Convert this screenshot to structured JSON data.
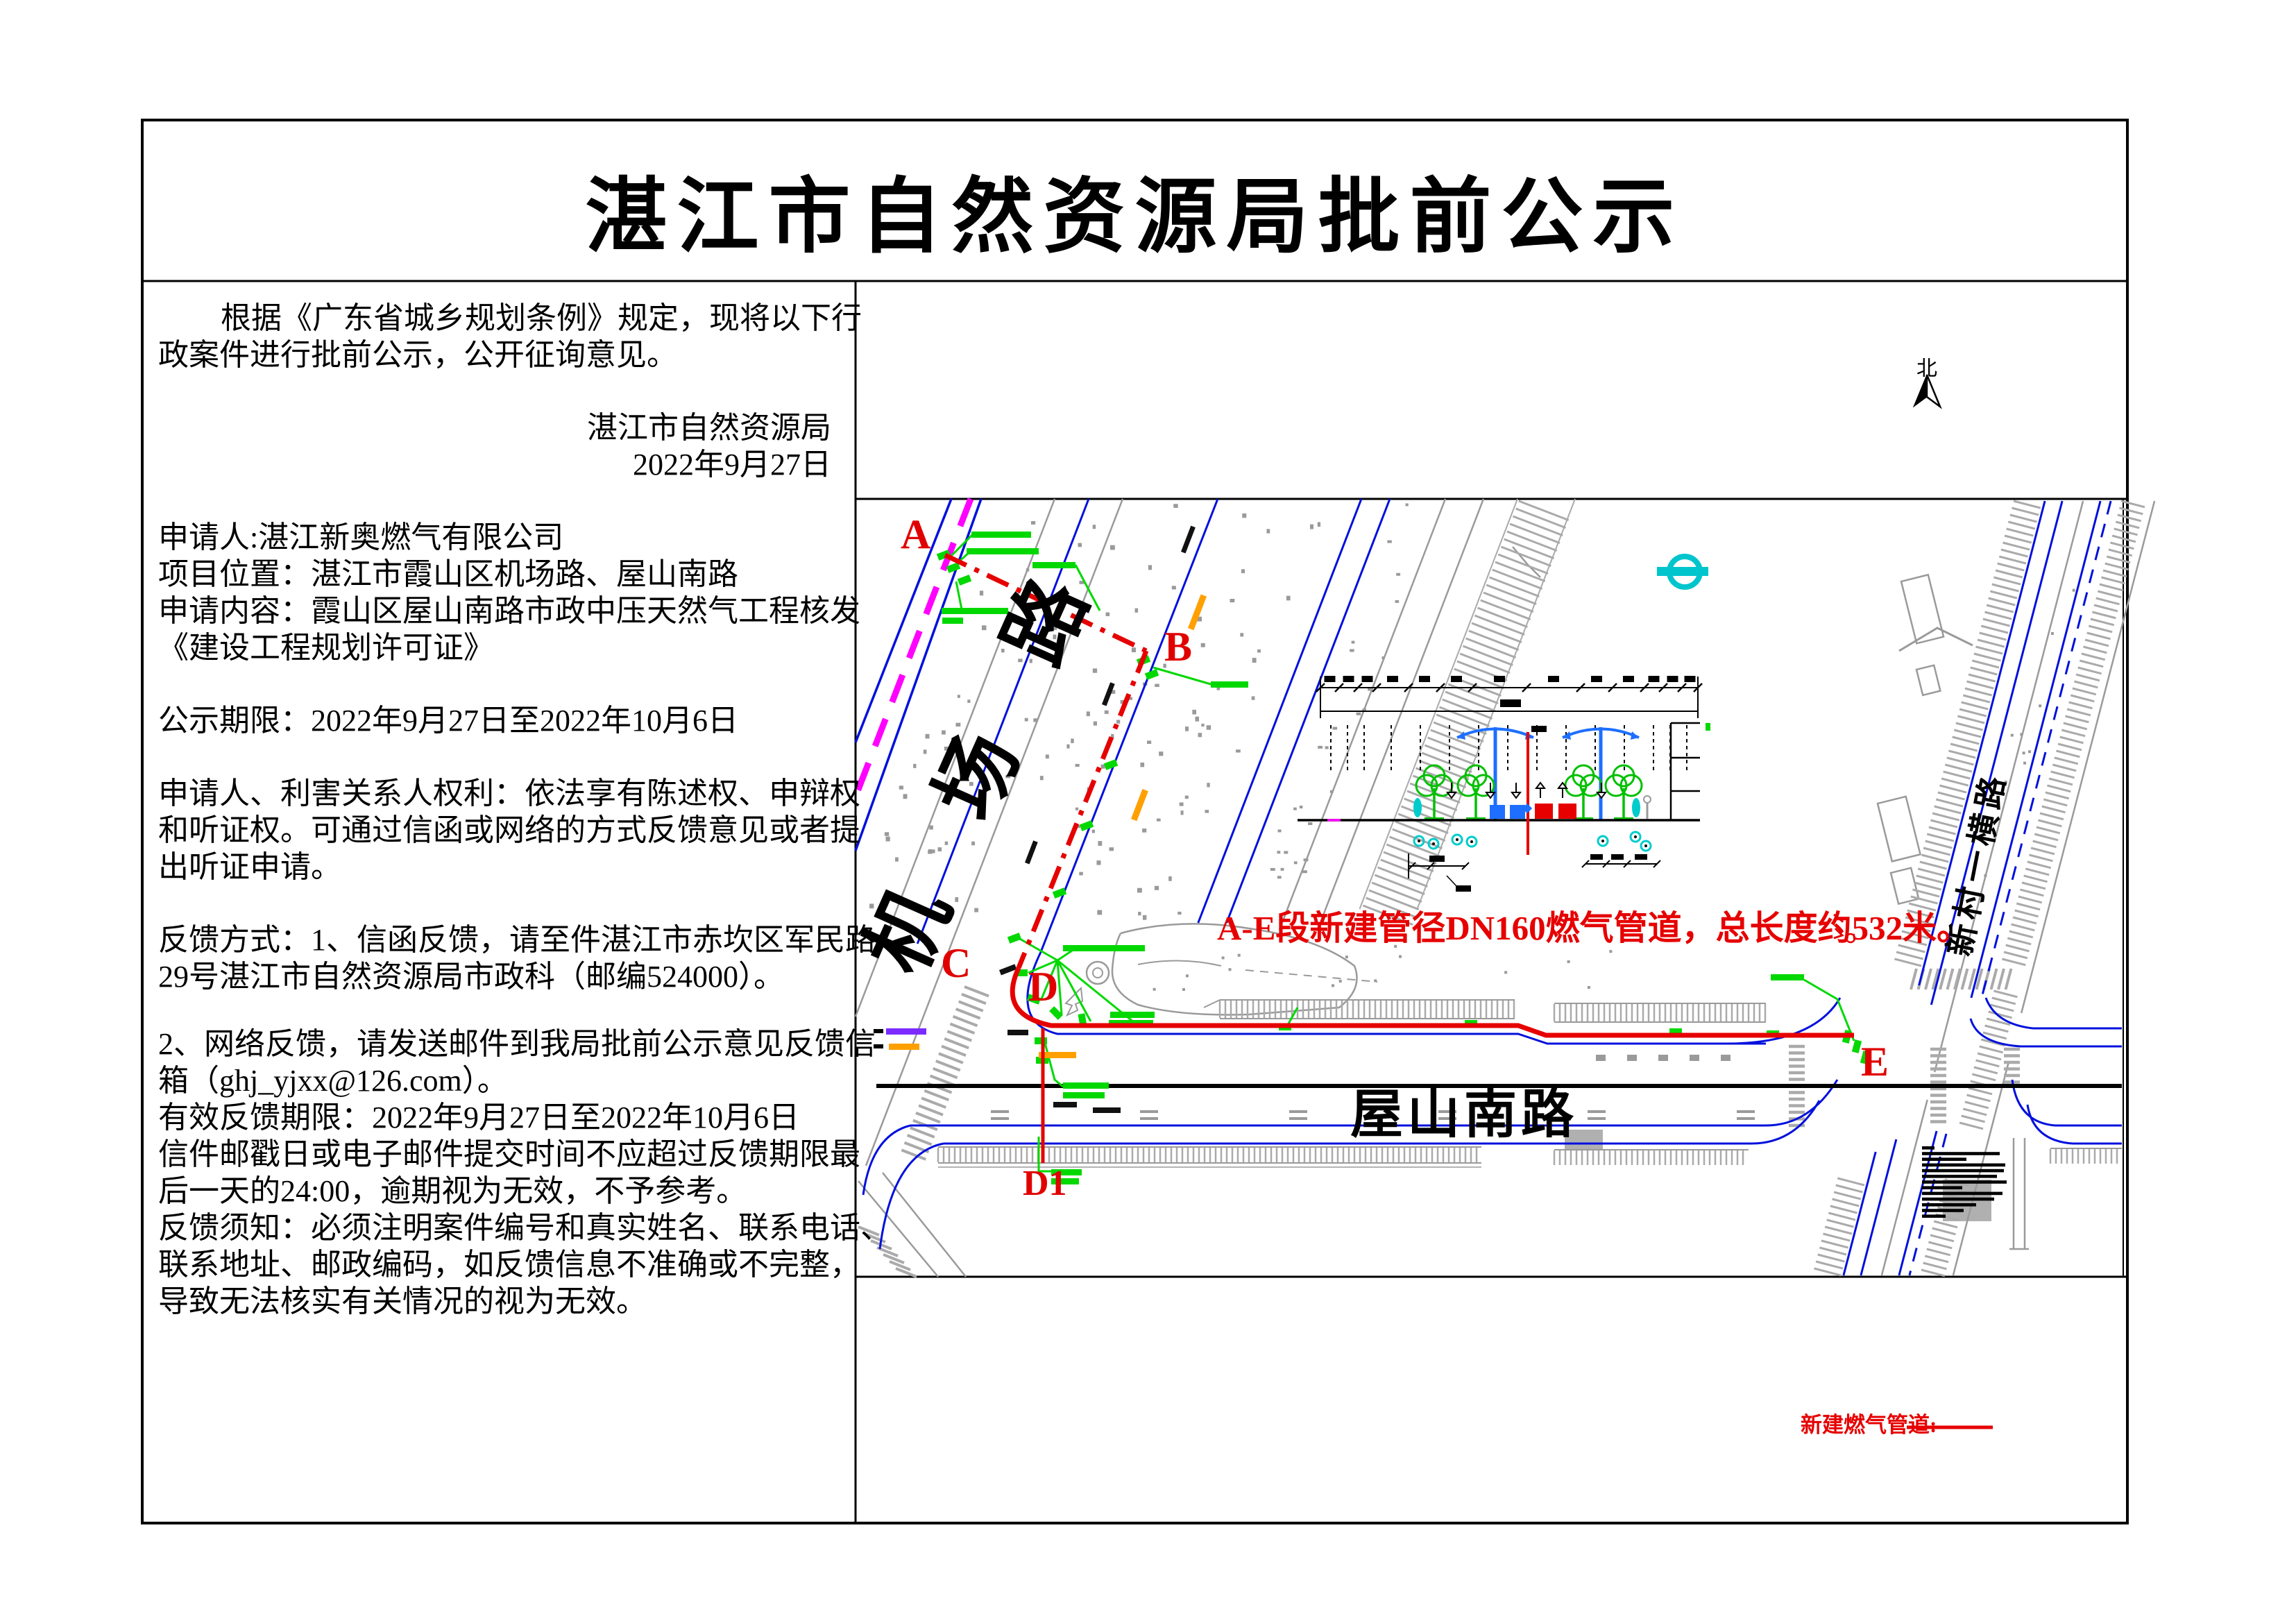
{
  "title": "湛江市自然资源局批前公示",
  "notice": {
    "lines": [
      "根据《广东省城乡规划条例》规定，现将以下行",
      "政案件进行批前公示，公开征询意见。",
      "湛江市自然资源局",
      "2022年9月27日",
      "申请人:湛江新奥燃气有限公司",
      "项目位置：湛江市霞山区机场路、屋山南路",
      "申请内容：霞山区屋山南路市政中压天然气工程核发",
      "《建设工程规划许可证》",
      "公示期限：2022年9月27日至2022年10月6日",
      "申请人、利害关系人权利：依法享有陈述权、申辩权",
      "和听证权。可通过信函或网络的方式反馈意见或者提",
      "出听证申请。",
      "反馈方式：1、信函反馈，请至件湛江市赤坎区军民路",
      "29号湛江市自然资源局市政科（邮编524000）。",
      "2、网络反馈，请发送邮件到我局批前公示意见反馈信",
      "箱（ghj_yjxx@126.com）。",
      "有效反馈期限：2022年9月27日至2022年10月6日",
      "信件邮戳日或电子邮件提交时间不应超过反馈期限最",
      "后一天的24:00，逾期视为无效，不予参考。",
      "反馈须知：必须注明案件编号和真实姓名、联系电话、",
      "联系地址、邮政编码，如反馈信息不准确或不完整，",
      "导致无法核实有关情况的视为无效。"
    ]
  },
  "map": {
    "north": "北",
    "roads": {
      "jichang": "机 场 路",
      "wushan": "屋山南路",
      "xincun": "新村一横路"
    },
    "points": {
      "a": "A",
      "b": "B",
      "c": "C",
      "d": "D",
      "d1": "D1",
      "e": "E"
    },
    "annotation": "A-E段新建管径DN160燃气管道，总长度约532米。",
    "legend": {
      "label": "新建燃气管道:"
    },
    "colors": {
      "new_pipeline_red": "#e60000",
      "annotation_green": "#00d800",
      "road_edge_blue": "#0010dd",
      "planning_boundary_magenta": "#ff00ff",
      "survey_symbol_cyan": "#00c5cd"
    }
  }
}
